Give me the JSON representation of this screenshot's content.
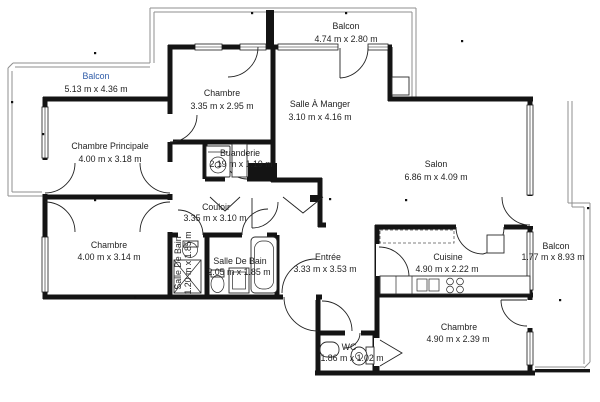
{
  "colors": {
    "wall": "#141414",
    "thin": "#8f8f8f",
    "ink": "#1f1f1f",
    "accent": "#2e5ba8",
    "bg": "#ffffff"
  },
  "rooms": [
    {
      "id": "balcon-top-left",
      "name": "Balcon",
      "dims": "5.13 m x 4.36 m"
    },
    {
      "id": "balcon-top",
      "name": "Balcon",
      "dims": "4.74 m x 2.80 m"
    },
    {
      "id": "chambre-nord",
      "name": "Chambre",
      "dims": "3.35 m x 2.95 m"
    },
    {
      "id": "salle-a-manger",
      "name": "Salle À Manger",
      "dims": "3.10 m x 4.16 m"
    },
    {
      "id": "chambre-principale",
      "name": "Chambre Principale",
      "dims": "4.00 m x 3.18 m"
    },
    {
      "id": "salon",
      "name": "Salon",
      "dims": "6.86 m x 4.09 m"
    },
    {
      "id": "buanderie",
      "name": "Buanderie",
      "dims": "2.19 m x 1.19 m"
    },
    {
      "id": "couloir",
      "name": "Couloir",
      "dims": "3.35 m x 3.10 m"
    },
    {
      "id": "chambre-ouest",
      "name": "Chambre",
      "dims": "4.00 m x 3.14 m"
    },
    {
      "id": "salle-de-bain-1",
      "name": "Salle De Bain",
      "dims": "1.20 m x 1.85 m"
    },
    {
      "id": "salle-de-bain-2",
      "name": "Salle De Bain",
      "dims": "2.05 m x 1.85 m"
    },
    {
      "id": "entree",
      "name": "Entrée",
      "dims": "3.33 m x 3.53 m"
    },
    {
      "id": "cuisine",
      "name": "Cuisine",
      "dims": "4.90 m x 2.22 m"
    },
    {
      "id": "balcon-droite",
      "name": "Balcon",
      "dims": "1.77 m x 8.93 m"
    },
    {
      "id": "chambre-sud",
      "name": "Chambre",
      "dims": "4.90 m x 2.39 m"
    },
    {
      "id": "wc",
      "name": "WC",
      "dims": "1.86 m x 1.02 m"
    }
  ]
}
